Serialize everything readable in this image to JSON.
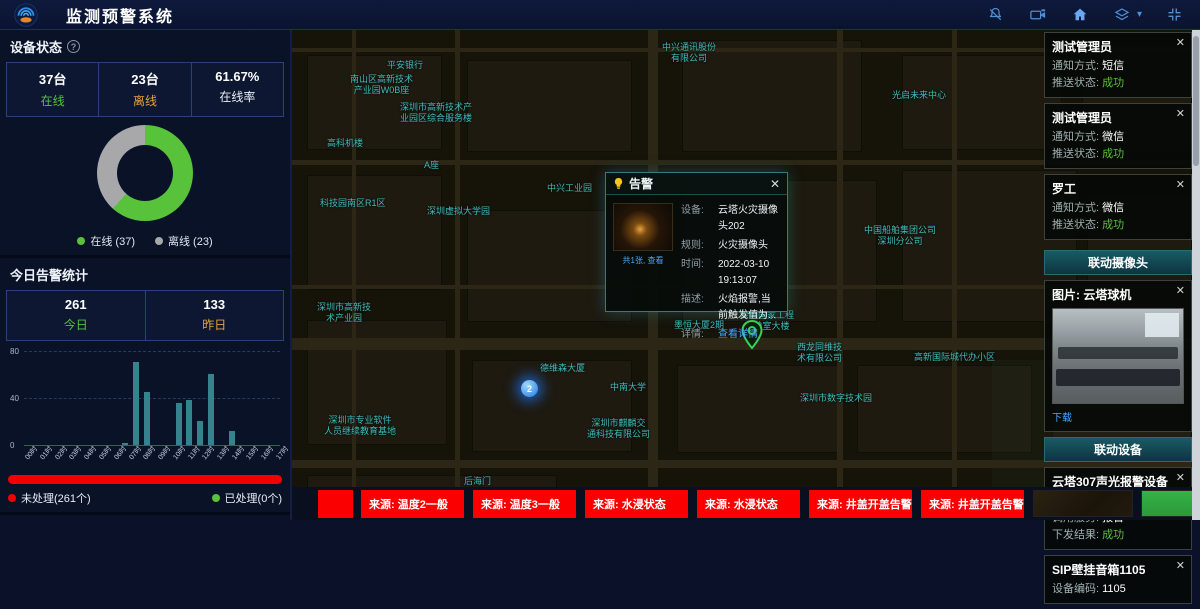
{
  "header": {
    "title": "监测预警系统",
    "icons": [
      "muted-bell-icon",
      "video-camera-icon",
      "home-icon",
      "layers-icon",
      "fullscreen-icon"
    ]
  },
  "colors": {
    "green": "#57c23a",
    "orange": "#e2a33d",
    "red": "#f20000",
    "bar_teal": "#35848d",
    "link_blue": "#4aa4ff",
    "map_label_teal": "#3fbdbd",
    "offline_gray": "#a8a8ab"
  },
  "left_panel": {
    "device_status": {
      "title": "设备状态",
      "stats": [
        {
          "value": "37台",
          "label": "在线"
        },
        {
          "value": "23台",
          "label": "离线"
        },
        {
          "value": "61.67%",
          "label": "在线率"
        }
      ],
      "legend": [
        {
          "label": "在线 (37)"
        },
        {
          "label": "离线 (23)"
        }
      ]
    },
    "today_alarms": {
      "title": "今日告警统计",
      "stats": [
        {
          "value": "261",
          "label": "今日"
        },
        {
          "value": "133",
          "label": "昨日"
        }
      ],
      "progress_legend": [
        {
          "label": "未处理(261个)"
        },
        {
          "label": "已处理(0个)"
        }
      ]
    },
    "month_alarms": {
      "title": "本月告警统计",
      "values": [
        "763",
        "1146"
      ]
    }
  },
  "chart_data": [
    {
      "type": "pie",
      "title": "设备状态",
      "labels": [
        "在线",
        "离线"
      ],
      "values": [
        37,
        23
      ],
      "colors": [
        "#57c23a",
        "#a8a8ab"
      ],
      "donut": true,
      "online_rate": "61.67%"
    },
    {
      "type": "bar",
      "title": "今日告警统计",
      "categories": [
        "00时",
        "01时",
        "02时",
        "03时",
        "04时",
        "05时",
        "06时",
        "07时",
        "08时",
        "09时",
        "10时",
        "11时",
        "12时",
        "13时",
        "14时",
        "15时",
        "16时",
        "17时",
        "18时",
        "19时",
        "20时",
        "21时",
        "22时",
        "23时"
      ],
      "values": [
        0,
        0,
        0,
        0,
        0,
        0,
        0,
        0,
        0,
        2,
        70,
        45,
        0,
        0,
        35,
        38,
        20,
        60,
        0,
        12,
        0,
        0,
        0,
        0
      ],
      "ylim": [
        0,
        80
      ],
      "y_ticks": [
        "80",
        "40",
        "0"
      ],
      "color": "#35848d",
      "grid": true,
      "legend_position": "none"
    }
  ],
  "map": {
    "cluster_count": "2",
    "labels": [
      {
        "text": "中兴通讯股份\n有限公司",
        "x": 370,
        "y": 12
      },
      {
        "text": "平安银行",
        "x": 95,
        "y": 30
      },
      {
        "text": "南山区高新技术\n产业园W0B座",
        "x": 58,
        "y": 44
      },
      {
        "text": "光启未来中心",
        "x": 600,
        "y": 60
      },
      {
        "text": "深圳市高新技术产\n业园区综合服务楼",
        "x": 108,
        "y": 72
      },
      {
        "text": "高科机楼",
        "x": 35,
        "y": 108
      },
      {
        "text": "A座",
        "x": 132,
        "y": 130
      },
      {
        "text": "中兴工业园",
        "x": 255,
        "y": 153
      },
      {
        "text": "科技园南区R1区",
        "x": 28,
        "y": 168
      },
      {
        "text": "深圳虚拟大学园",
        "x": 135,
        "y": 176
      },
      {
        "text": "中国船舶集团公司\n深圳分公司",
        "x": 572,
        "y": 195
      },
      {
        "text": "深圳市高新技\n术产业园",
        "x": 25,
        "y": 272
      },
      {
        "text": "墨恒大厦2期",
        "x": 382,
        "y": 290
      },
      {
        "text": "深圳国家工程\n实验室大楼",
        "x": 448,
        "y": 280
      },
      {
        "text": "西龙同维技\n术有限公司",
        "x": 505,
        "y": 312
      },
      {
        "text": "高新国际城代办小区",
        "x": 622,
        "y": 322
      },
      {
        "text": "德维森大厦",
        "x": 248,
        "y": 333
      },
      {
        "text": "中南大学",
        "x": 318,
        "y": 352
      },
      {
        "text": "深圳市数字技术园",
        "x": 508,
        "y": 363
      },
      {
        "text": "深圳市麒麟交\n通科技有限公司",
        "x": 295,
        "y": 388
      },
      {
        "text": "深圳市专业软件\n人员继续教育基地",
        "x": 32,
        "y": 385
      },
      {
        "text": "后海门",
        "x": 172,
        "y": 446
      }
    ]
  },
  "popup": {
    "title": "告警",
    "close": "✕",
    "thumb_caption": "共1张, 查看",
    "rows": [
      {
        "label": "设备:",
        "value": "云塔火灾摄像头202"
      },
      {
        "label": "规则:",
        "value": "火灾摄像头"
      },
      {
        "label": "时间:",
        "value": "2022-03-10 19:13:07"
      },
      {
        "label": "描述:",
        "value": "火焰报警,当前触发值为..."
      },
      {
        "label": "详情:",
        "value": "查看详情",
        "link": true
      }
    ]
  },
  "right_panel": {
    "close": "✕",
    "notifications": [
      {
        "name": "测试管理员",
        "rows": [
          {
            "label": "通知方式:",
            "value": "短信"
          },
          {
            "label": "推送状态:",
            "value": "成功",
            "status": true
          }
        ]
      },
      {
        "name": "测试管理员",
        "rows": [
          {
            "label": "通知方式:",
            "value": "微信"
          },
          {
            "label": "推送状态:",
            "value": "成功",
            "status": true
          }
        ]
      },
      {
        "name": "罗工",
        "rows": [
          {
            "label": "通知方式:",
            "value": "微信"
          },
          {
            "label": "推送状态:",
            "value": "成功",
            "status": true
          }
        ]
      }
    ],
    "camera_header": "联动摄像头",
    "camera_card": {
      "title": "图片: 云塔球机",
      "download_label": "下载"
    },
    "device_header": "联动设备",
    "device_cards": [
      {
        "name": "云塔307声光报警设备",
        "rows": [
          {
            "label": "设备编码:",
            "value": "ffffff100001ab6c"
          },
          {
            "label": "调用服务:",
            "value": "报警"
          },
          {
            "label": "下发结果:",
            "value": "成功",
            "status": true
          }
        ]
      },
      {
        "name": "SIP壁挂音箱1105",
        "rows": [
          {
            "label": "设备编码:",
            "value": "1105"
          }
        ]
      }
    ]
  },
  "bottom_bar": {
    "alerts": [
      "来源: 温度2一般",
      "来源: 温度3一般",
      "来源: 水浸状态",
      "来源: 水浸状态",
      "来源: 井盖开盖告警",
      "来源: 井盖开盖告警"
    ]
  }
}
